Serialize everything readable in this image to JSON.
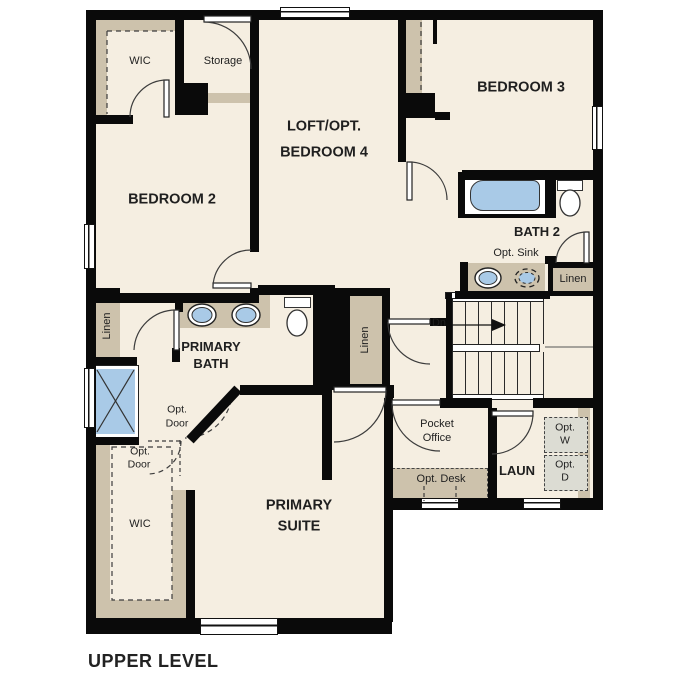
{
  "colors": {
    "wall": "#0a0a0a",
    "floor": "#f5eee1",
    "tan": "#cdc2ac",
    "blue": "#a9cae7",
    "optbox": "#dcdcd3",
    "text": "#1f1f1f"
  },
  "labels": {
    "wic_upper": "WIC",
    "storage": "Storage",
    "bedroom2": "BEDROOM 2",
    "loft": {
      "line1": "LOFT/OPT.",
      "line2": "BEDROOM 4"
    },
    "bedroom3": "BEDROOM 3",
    "bath2": "BATH 2",
    "opt_sink": "Opt. Sink",
    "linen": "Linen",
    "dn": "Dn",
    "primary_bath": {
      "line1": "PRIMARY",
      "line2": "BATH"
    },
    "opt_door": {
      "line1": "Opt.",
      "line2": "Door"
    },
    "pocket_office": {
      "line1": "Pocket",
      "line2": "Office"
    },
    "opt_desk": "Opt. Desk",
    "laun": "LAUN",
    "opt_w": {
      "line1": "Opt.",
      "line2": "W"
    },
    "opt_d": {
      "line1": "Opt.",
      "line2": "D"
    },
    "wic_lower": "WIC",
    "primary_suite": {
      "line1": "PRIMARY",
      "line2": "SUITE"
    },
    "plan_title": "UPPER LEVEL"
  }
}
